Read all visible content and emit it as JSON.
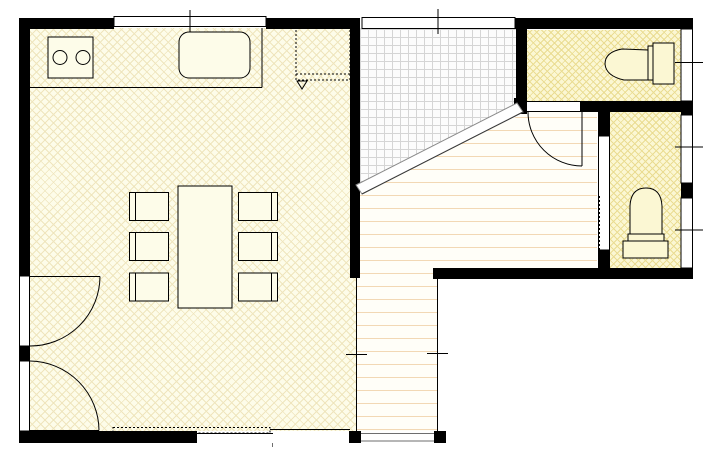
{
  "drawing": {
    "kind": "architectural-floor-plan",
    "visible_text": "none"
  },
  "colors": {
    "plan_bg": "#FFFFFF",
    "wall": "#000000",
    "room_fill": "#FDFCE9",
    "room_hatch": "#EFE5BD",
    "bath_fill": "#FBF7D3",
    "bath_hatch": "#EADC92",
    "hall_bg": "#FFFEF8",
    "hall_plank": "#F2D8B5",
    "entry_bg": "#FCFCFC",
    "entry_grid": "#D5D5D5",
    "diag_edge": "#8A8A8A",
    "threshold_gray": "#888888"
  },
  "areas": [
    {
      "name": "kitchen-living-dining",
      "floor_pattern": "pale-yellow-crosshatch"
    },
    {
      "name": "tiled-entry",
      "floor_pattern": "gray-grid"
    },
    {
      "name": "hallway-corridor",
      "floor_pattern": "plank-lines"
    },
    {
      "name": "bathroom-1",
      "floor_pattern": "yellow-crosshatch"
    },
    {
      "name": "bathroom-2",
      "floor_pattern": "yellow-crosshatch"
    }
  ],
  "fixtures": {
    "cooktop_burners": 2,
    "sink": 1,
    "refrigerator_dashed": 1,
    "dining_table": 1,
    "chairs": 6,
    "toilets": 2,
    "swing_doors": 3,
    "double_entry_doors": 2,
    "windows_top": 2,
    "windows_right": 3,
    "window_ticks": 5,
    "wall_cross_marks": 2
  }
}
